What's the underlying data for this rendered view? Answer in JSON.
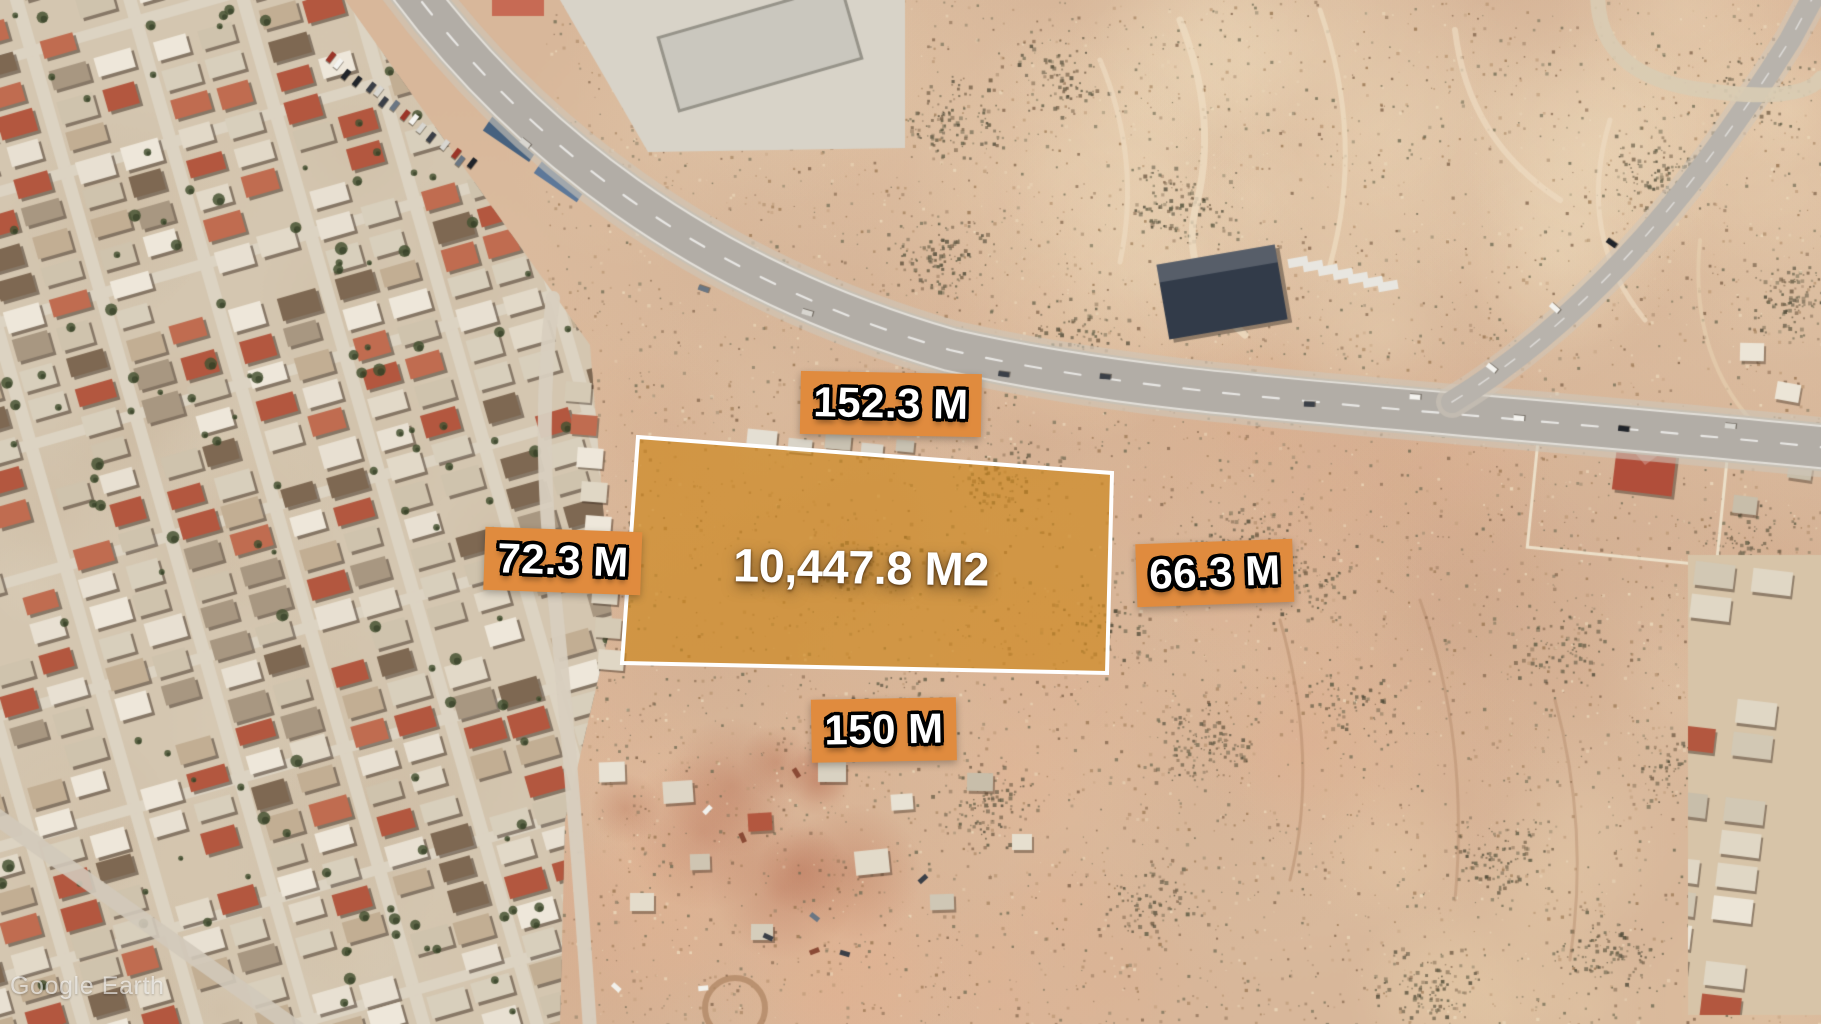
{
  "annotations": {
    "area_label": "10,447.8 M2",
    "measurements": {
      "top": "152.3 M",
      "left": "72.3 M",
      "right": "66.3 M",
      "bottom": "150 M"
    }
  },
  "watermark": "Google Earth",
  "colors": {
    "parcel_fill": "#D88E1E",
    "parcel_border": "#FFFFFF",
    "label_background": "#E08B3E",
    "label_text": "#FFFFFF"
  }
}
